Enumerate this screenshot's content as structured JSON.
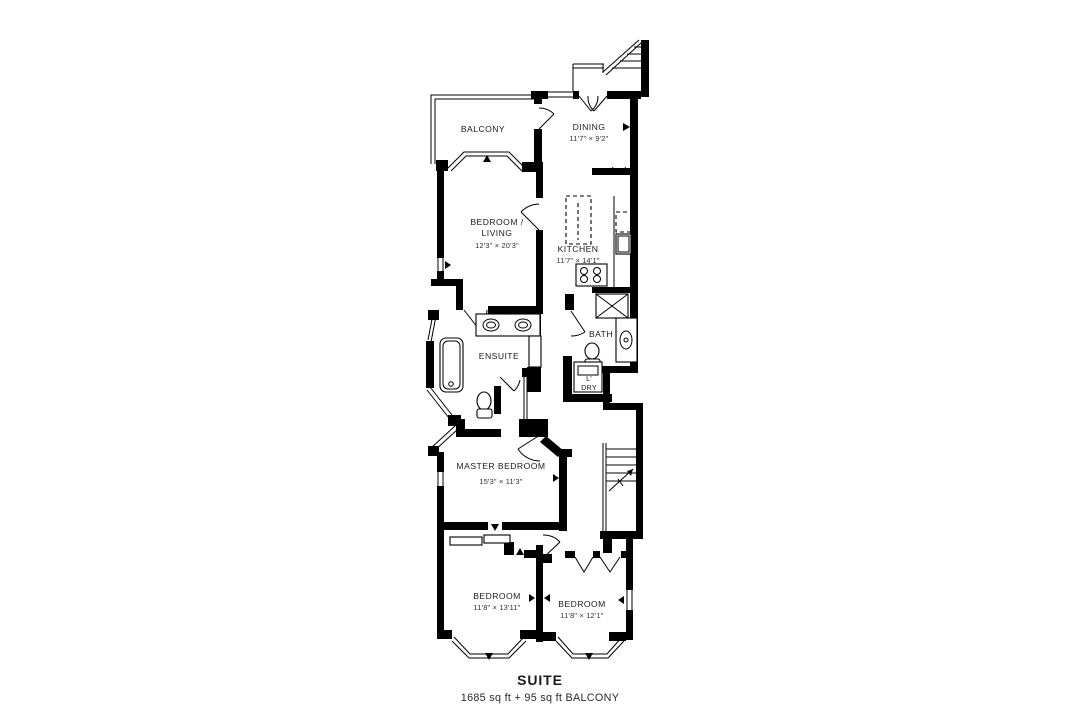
{
  "colors": {
    "walls": "#000000",
    "background": "#ffffff",
    "text": "#1b1b1b"
  },
  "rooms": {
    "balcony": {
      "label": "BALCONY"
    },
    "dining": {
      "label": "DINING",
      "dims": "11'7\" × 9'2\""
    },
    "bedroom_living": {
      "label_line1": "BEDROOM /",
      "label_line2": "LIVING",
      "dims": "12'3\" × 20'3\""
    },
    "kitchen": {
      "label": "KITCHEN",
      "dims": "11'7\" × 14'1\""
    },
    "ensuite": {
      "label": "ENSUITE"
    },
    "bath": {
      "label": "BATH"
    },
    "laundry": {
      "label_line1": "L'",
      "label_line2": "DRY"
    },
    "master": {
      "label": "MASTER BEDROOM",
      "dims": "15'3\" × 11'3\""
    },
    "bedroom2": {
      "label": "BEDROOM",
      "dims": "11'8\" × 13'11\""
    },
    "bedroom3": {
      "label": "BEDROOM",
      "dims": "11'8\" × 12'1\""
    }
  },
  "footer": {
    "title": "SUITE",
    "area": "1685 sq ft + 95 sq ft BALCONY"
  }
}
